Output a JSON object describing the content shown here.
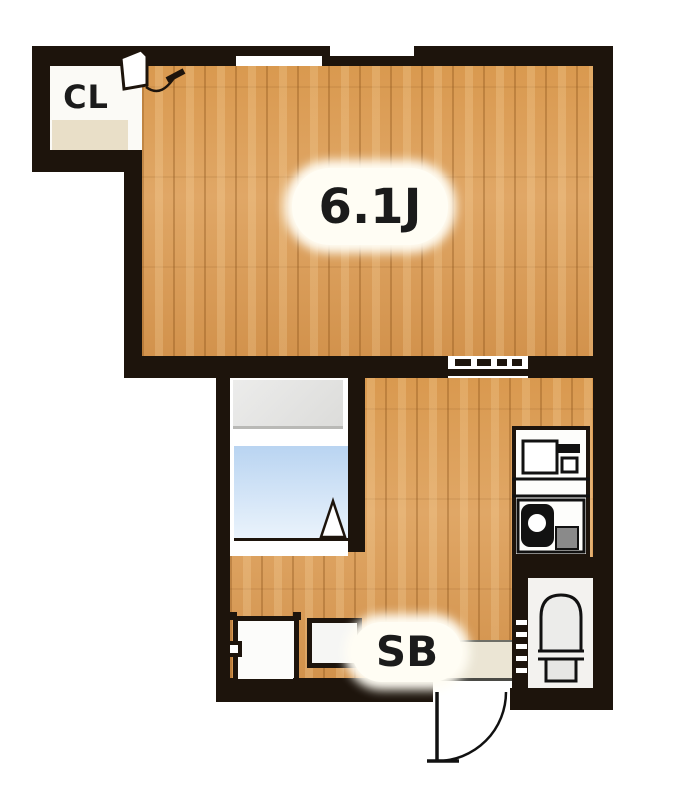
{
  "plan": {
    "type": "apartment-floor-plan",
    "rooms": {
      "main_room": {
        "label": "6.1J"
      },
      "closet": {
        "label": "CL"
      },
      "shoe_box": {
        "label": "SB"
      }
    },
    "fixtures": [
      {
        "name": "closet-door-icon"
      },
      {
        "name": "sliding-window-icon"
      },
      {
        "name": "sliding-door-icon"
      },
      {
        "name": "bathtub-icon"
      },
      {
        "name": "bathroom-door-swing-icon"
      },
      {
        "name": "kitchen-sink-icon"
      },
      {
        "name": "gas-stove-icon"
      },
      {
        "name": "toilet-icon"
      },
      {
        "name": "folding-door-icon"
      },
      {
        "name": "washing-machine-pan-icon"
      },
      {
        "name": "shoe-cabinet-icon"
      },
      {
        "name": "genkan-entrance"
      },
      {
        "name": "entrance-door-swing-icon"
      }
    ],
    "colors": {
      "wall": "#1d140c",
      "wood": "#d9994f",
      "bath_blue_top": "#b9d4f1",
      "bath_blue_bottom": "#eaf3fc",
      "unit_gray": "#e3e3e1",
      "shelf_beige": "#e9dfc8",
      "genkan_beige": "#ebe5d4",
      "toilet_floor": "#f3f2ef",
      "label_bg": "#fffdf4",
      "text_dark": "#1b1b1b"
    }
  }
}
